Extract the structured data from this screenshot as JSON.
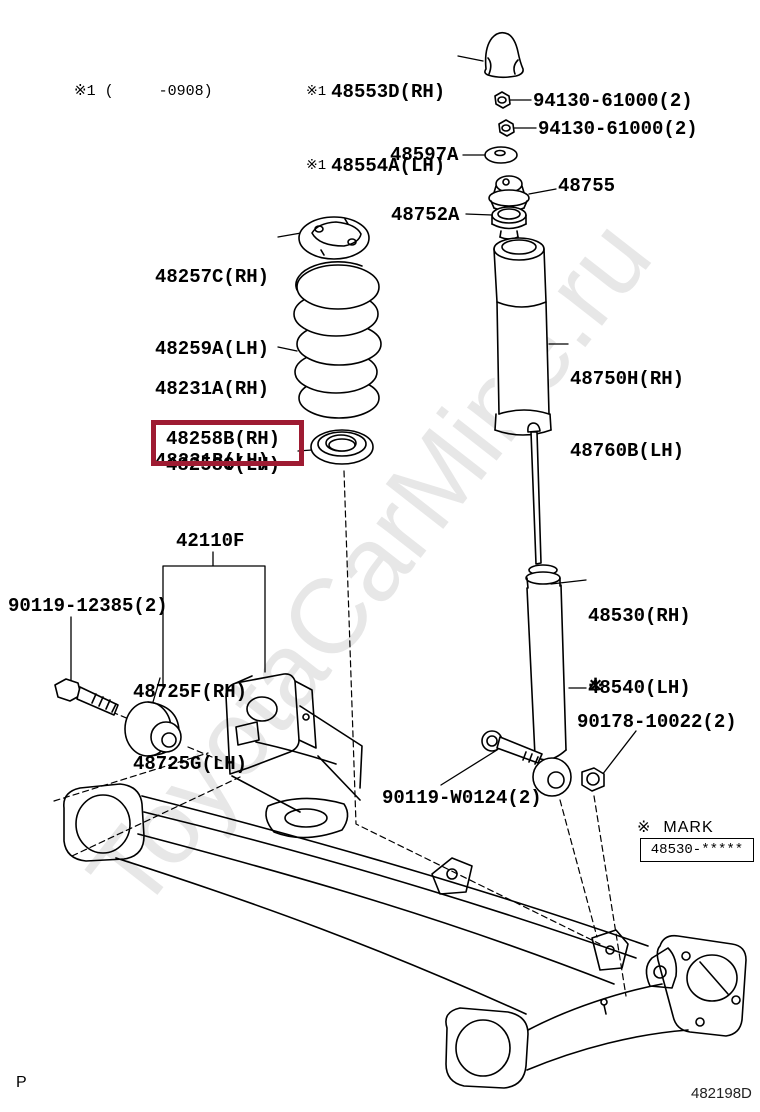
{
  "watermark": "ToyotaCarMine.ru",
  "applicability_note": "※1 (     -0908)",
  "parts": {
    "bump_stop": {
      "ref": "※1",
      "rh": "48553D(RH)",
      "lh": "48554A(LH)"
    },
    "nut_upper_1": {
      "num": "94130-61000(2)"
    },
    "nut_upper_2": {
      "num": "94130-61000(2)"
    },
    "washer": {
      "num": "48597A"
    },
    "support": {
      "num": "48755"
    },
    "bearing": {
      "num": "48752A"
    },
    "spring_seat_upper": {
      "rh": "48257C(RH)",
      "lh": "48259A(LH)"
    },
    "coil_spring": {
      "rh": "48231A(RH)",
      "lh": "48231B(LH)"
    },
    "spring_insulator_lower": {
      "rh": "48258B(RH)",
      "lh": "48258C(LH)"
    },
    "dust_cover": {
      "rh": "48750H(RH)",
      "lh": "48760B(LH)"
    },
    "axle_beam": {
      "num": "42110F"
    },
    "axle_bolt": {
      "num": "90119-12385(2)"
    },
    "arm_bushing": {
      "rh": "48725F(RH)",
      "lh": "48725G(LH)"
    },
    "shock_absorber": {
      "rh": "48530(RH)",
      "lh": "48540(LH)",
      "mark": "※"
    },
    "shock_nut": {
      "num": "90178-10022(2)"
    },
    "shock_bolt": {
      "num": "90119-W0124(2)"
    }
  },
  "mark_table": {
    "symbol": "※",
    "header": "MARK",
    "value": "48530-*****"
  },
  "footer": {
    "page_letter": "P",
    "diagram_code": "482198D"
  },
  "colors": {
    "highlight": "#9e1b32",
    "line": "#000000",
    "watermark": "#e7e7e7"
  }
}
